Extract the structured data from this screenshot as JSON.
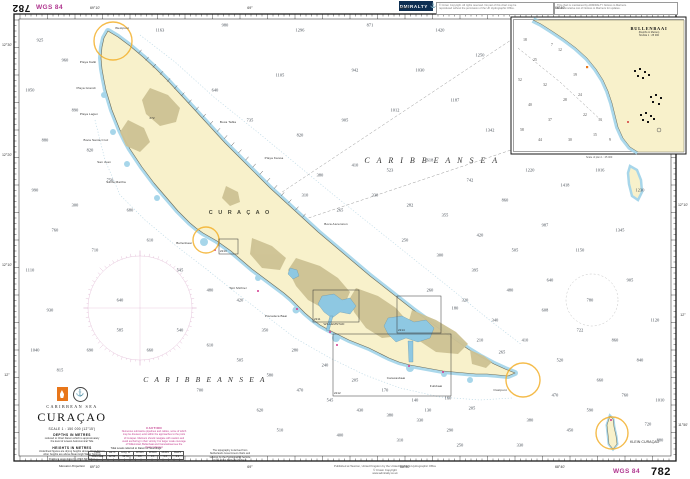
{
  "chart": {
    "number": "782",
    "datum": "WGS 84",
    "title": "CURAÇAO",
    "region": "CARIBBEAN SEA"
  },
  "margin_top": {
    "chart_no": "782",
    "datum": "WGS 84",
    "admiralty": "ADMIRALTY",
    "anchor_icon": "anchor",
    "box1_lines": [
      "© Crown Copyright. All rights reserved. No part of this chart may be",
      "reproduced without the permission of the UK Hydrographic Office."
    ],
    "box2_lines": [
      "This chart is maintained by ADMIRALTY Notices to Mariners.",
      "See Cumulative List of Notices to Mariners for updates."
    ]
  },
  "margin_bottom": {
    "chart_no": "782",
    "datum": "WGS 84",
    "publication_lines": [
      "Published at Taunton, United Kingdom by the United Kingdom Hydrographic Office",
      "© Crown Copyright",
      "www.admiralty.co.uk"
    ]
  },
  "title_block": {
    "region": "CARIBBEAN SEA",
    "title": "CURAÇAO",
    "scale": "SCALE 1 : 150 000 (12°15')",
    "depths_heading": "DEPTHS IN METRES",
    "depths_note_1": "reduced to Chart Datum which is approximately",
    "depths_note_2": "the level of Lowest Astronomical Tide",
    "heights_heading": "HEIGHTS IN METRES",
    "heights_note_1": "Underlined figures are drying heights above Chart Datum;",
    "heights_note_2": "other heights are above Mean High Water Springs",
    "positions_note": "Positions are referred to WGS 84 Datum",
    "projection": "Mercator Projection"
  },
  "caution": {
    "heading": "CAUTION",
    "lines": [
      "Numerous submarine pipelines and cables, some of which",
      "may be disused, exist within the approaches to the ports",
      "of Curaçao. Mariners should navigate with caution and",
      "avoid anchoring in their vicinity. For larger scale coverage",
      "of Willemstad, Bullenbaai and Caracasbaai see the",
      "charts indicated."
    ]
  },
  "tidal_table": {
    "caption": "Tidal Levels referred to Datum of Soundings",
    "headers": [
      "Place",
      "Lat. N.",
      "Long. W.",
      "MHWS",
      "MHWN",
      "MLWN",
      "MLWS"
    ],
    "row": [
      "Willemstad",
      "12°06′",
      "68°56′",
      "0.5",
      "0.4",
      "0.3",
      "0.1"
    ]
  },
  "source_note": {
    "lines": [
      "The topography is derived from",
      "Netherlands Government charts and",
      "surveys by the Hydrographic Service",
      "of the Royal Netherlands Navy."
    ]
  },
  "sea_labels": {
    "sea_ne": "C A R I B B E A N   S E A",
    "sea_sw": "C A R I B B E A N   S E A",
    "island": "C U R A Ç A O",
    "klein": "KLEIN CURAÇAO",
    "peak": "372"
  },
  "inset": {
    "title": "BULLENBAAI",
    "sub1": "(Depths in Metres)",
    "sub2": "SCALE 1 : 25 000",
    "caption": "Scale of plan 1 : 25 000"
  },
  "place_names": [
    {
      "x": 122,
      "y": 28,
      "t": "Westpunt"
    },
    {
      "x": 88,
      "y": 62,
      "t": "Playa Kalki"
    },
    {
      "x": 86,
      "y": 88,
      "t": "Playa Grandi"
    },
    {
      "x": 89,
      "y": 114,
      "t": "Playa Lagun"
    },
    {
      "x": 96,
      "y": 140,
      "t": "Boca Santa Cruz"
    },
    {
      "x": 104,
      "y": 162,
      "t": "San Juan"
    },
    {
      "x": 116,
      "y": 182,
      "t": "Santa Martha"
    },
    {
      "x": 184,
      "y": 243,
      "t": "Bullenbaai"
    },
    {
      "x": 238,
      "y": 288,
      "t": "Sint Michiel"
    },
    {
      "x": 276,
      "y": 316,
      "t": "Piscadera Baai"
    },
    {
      "x": 334,
      "y": 324,
      "t": "WILLEMSTAD"
    },
    {
      "x": 396,
      "y": 378,
      "t": "Caracasbaai"
    },
    {
      "x": 436,
      "y": 386,
      "t": "Fuikbaai"
    },
    {
      "x": 500,
      "y": 390,
      "t": "Oostpunt"
    },
    {
      "x": 228,
      "y": 122,
      "t": "Boca Tabla"
    },
    {
      "x": 274,
      "y": 158,
      "t": "Playa Kanoa"
    },
    {
      "x": 336,
      "y": 224,
      "t": "Boca Ascension"
    },
    {
      "x": 152,
      "y": 118,
      "t": "372"
    }
  ],
  "graticule": {
    "top": [
      {
        "x": 95,
        "t": "69°10'"
      },
      {
        "x": 250,
        "t": "69°"
      },
      {
        "x": 405,
        "t": "68°50'"
      },
      {
        "x": 560,
        "t": "68°40'"
      }
    ],
    "bottom": [
      {
        "x": 95,
        "t": "69°10'"
      },
      {
        "x": 250,
        "t": "69°"
      },
      {
        "x": 405,
        "t": "68°50'"
      },
      {
        "x": 560,
        "t": "68°40'"
      }
    ],
    "left": [
      {
        "y": 45,
        "t": "12°30'"
      },
      {
        "y": 155,
        "t": "12°20'"
      },
      {
        "y": 265,
        "t": "12°10'"
      },
      {
        "y": 375,
        "t": "12°"
      }
    ],
    "right": [
      {
        "y": 205,
        "t": "12°10'"
      },
      {
        "y": 315,
        "t": "12°"
      },
      {
        "y": 425,
        "t": "11°50'"
      }
    ]
  },
  "chart_limit_boxes": [
    {
      "x": 219,
      "y": 239,
      "w": 19,
      "h": 15,
      "label": "2213"
    },
    {
      "x": 313,
      "y": 290,
      "w": 46,
      "h": 32,
      "label": "2211"
    },
    {
      "x": 397,
      "y": 296,
      "w": 44,
      "h": 37,
      "label": "2214"
    },
    {
      "x": 333,
      "y": 334,
      "w": 118,
      "h": 62,
      "label": "2212"
    }
  ],
  "soundings": [
    [
      160,
      30,
      1163
    ],
    [
      225,
      25,
      980
    ],
    [
      300,
      30,
      1296
    ],
    [
      370,
      25,
      871
    ],
    [
      440,
      30,
      1420
    ],
    [
      480,
      55,
      1250
    ],
    [
      420,
      70,
      1030
    ],
    [
      355,
      70,
      942
    ],
    [
      280,
      75,
      1105
    ],
    [
      215,
      90,
      640
    ],
    [
      250,
      120,
      735
    ],
    [
      300,
      135,
      820
    ],
    [
      345,
      120,
      905
    ],
    [
      395,
      110,
      1012
    ],
    [
      455,
      100,
      1187
    ],
    [
      490,
      130,
      1342
    ],
    [
      530,
      170,
      1220
    ],
    [
      565,
      185,
      1418
    ],
    [
      600,
      170,
      1016
    ],
    [
      640,
      190,
      1230
    ],
    [
      620,
      230,
      1345
    ],
    [
      580,
      250,
      1150
    ],
    [
      545,
      225,
      987
    ],
    [
      505,
      200,
      860
    ],
    [
      470,
      180,
      742
    ],
    [
      430,
      160,
      618
    ],
    [
      390,
      170,
      523
    ],
    [
      355,
      165,
      410
    ],
    [
      320,
      175,
      380
    ],
    [
      305,
      195,
      310
    ],
    [
      340,
      210,
      265
    ],
    [
      375,
      195,
      330
    ],
    [
      410,
      205,
      282
    ],
    [
      445,
      215,
      355
    ],
    [
      480,
      235,
      420
    ],
    [
      515,
      250,
      505
    ],
    [
      550,
      280,
      640
    ],
    [
      590,
      300,
      780
    ],
    [
      630,
      280,
      905
    ],
    [
      655,
      320,
      1120
    ],
    [
      615,
      340,
      860
    ],
    [
      580,
      330,
      722
    ],
    [
      545,
      310,
      608
    ],
    [
      510,
      290,
      480
    ],
    [
      475,
      270,
      395
    ],
    [
      440,
      255,
      300
    ],
    [
      405,
      240,
      250
    ],
    [
      465,
      300,
      320
    ],
    [
      430,
      290,
      260
    ],
    [
      495,
      320,
      340
    ],
    [
      525,
      340,
      410
    ],
    [
      560,
      360,
      520
    ],
    [
      600,
      380,
      660
    ],
    [
      640,
      360,
      840
    ],
    [
      660,
      400,
      1010
    ],
    [
      625,
      395,
      760
    ],
    [
      590,
      410,
      590
    ],
    [
      555,
      395,
      470
    ],
    [
      530,
      420,
      380
    ],
    [
      570,
      430,
      450
    ],
    [
      648,
      424,
      720
    ],
    [
      660,
      440,
      880
    ],
    [
      480,
      340,
      210
    ],
    [
      455,
      308,
      180
    ],
    [
      502,
      352,
      265
    ],
    [
      472,
      408,
      205
    ],
    [
      448,
      398,
      160
    ],
    [
      428,
      410,
      130
    ],
    [
      40,
      40,
      925
    ],
    [
      30,
      90,
      1050
    ],
    [
      45,
      140,
      880
    ],
    [
      35,
      190,
      990
    ],
    [
      55,
      230,
      760
    ],
    [
      30,
      270,
      1110
    ],
    [
      50,
      310,
      930
    ],
    [
      35,
      350,
      1040
    ],
    [
      60,
      370,
      815
    ],
    [
      90,
      350,
      690
    ],
    [
      120,
      330,
      585
    ],
    [
      150,
      350,
      660
    ],
    [
      180,
      330,
      540
    ],
    [
      210,
      345,
      610
    ],
    [
      240,
      360,
      505
    ],
    [
      270,
      375,
      580
    ],
    [
      300,
      390,
      470
    ],
    [
      330,
      400,
      545
    ],
    [
      360,
      410,
      430
    ],
    [
      390,
      415,
      380
    ],
    [
      420,
      420,
      330
    ],
    [
      450,
      430,
      290
    ],
    [
      240,
      300,
      420
    ],
    [
      210,
      290,
      480
    ],
    [
      180,
      270,
      545
    ],
    [
      150,
      240,
      610
    ],
    [
      130,
      210,
      680
    ],
    [
      110,
      180,
      750
    ],
    [
      90,
      150,
      820
    ],
    [
      75,
      110,
      890
    ],
    [
      65,
      60,
      960
    ],
    [
      75,
      205,
      300
    ],
    [
      265,
      330,
      350
    ],
    [
      295,
      350,
      280
    ],
    [
      325,
      365,
      240
    ],
    [
      355,
      380,
      205
    ],
    [
      385,
      390,
      170
    ],
    [
      415,
      400,
      140
    ],
    [
      260,
      410,
      620
    ],
    [
      200,
      390,
      700
    ],
    [
      280,
      430,
      510
    ],
    [
      340,
      435,
      400
    ],
    [
      400,
      440,
      310
    ],
    [
      460,
      445,
      250
    ],
    [
      520,
      445,
      330
    ],
    [
      95,
      250,
      710
    ],
    [
      120,
      300,
      640
    ]
  ],
  "inset_soundings": [
    [
      525,
      40,
      18
    ],
    [
      535,
      60,
      25
    ],
    [
      545,
      85,
      32
    ],
    [
      530,
      105,
      40
    ],
    [
      550,
      120,
      37
    ],
    [
      565,
      100,
      28
    ],
    [
      575,
      75,
      19
    ],
    [
      560,
      50,
      12
    ],
    [
      585,
      115,
      22
    ],
    [
      595,
      135,
      15
    ],
    [
      570,
      140,
      30
    ],
    [
      540,
      140,
      44
    ],
    [
      610,
      140,
      9
    ],
    [
      600,
      120,
      13
    ],
    [
      552,
      45,
      7
    ],
    [
      520,
      80,
      52
    ],
    [
      522,
      130,
      58
    ],
    [
      580,
      95,
      24
    ]
  ],
  "colors": {
    "land": "#f8f1cb",
    "shallow": "#a7d6ea",
    "olive": "#cdc294",
    "magenta": "#c23a8c",
    "orange": "#f3b02c",
    "navy": "#0e2f52",
    "frame": "#1a1a1a"
  }
}
